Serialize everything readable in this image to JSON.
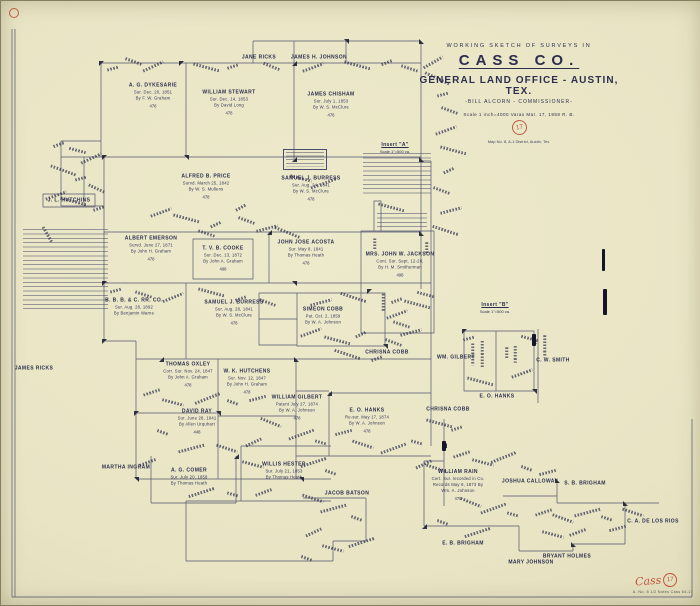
{
  "document": {
    "header": {
      "kicker": "WORKING SKETCH OF SURVEYS IN",
      "county": "CASS CO.",
      "office": "GENERAL LAND OFFICE - AUSTIN, TEX.",
      "commissioner": "-BILL ALCORN - COMMISSIONER-",
      "scale_date": "Scale 1 inch=4000 Varas      Mar. 17, 1958  R. B.",
      "sheet_number": "17",
      "credit": "Map No. 8, A-1 District, Austin, Tex."
    },
    "sheet_stamp": {
      "county_red": "Cass",
      "number": "17",
      "file_note": "A. No. 8  1/2 Notes      Cass 64-17"
    },
    "inserts": [
      {
        "label": "Insert \"A\"",
        "scale": "Scale 1\"=500 va."
      },
      {
        "label": "Insert \"B\"",
        "scale": "Scale 1\"=500 va."
      }
    ],
    "surveys": [
      {
        "n": "Jane Ricks"
      },
      {
        "n": "James H. Johnson"
      },
      {
        "n": "A. G. Dykesarie",
        "d1": "Sur. Dec. 20, 1851",
        "d2": "By F. W. Graham",
        "a": "478"
      },
      {
        "n": "William Stewart",
        "d1": "Sur. Dec. 14, 1853",
        "d2": "By David Long",
        "a": "478"
      },
      {
        "n": "James Chisham",
        "d1": "Sur. July 1, 1853",
        "d2": "By W. S. McClure",
        "a": "478"
      },
      {
        "n": "Alfred B. Price",
        "d1": "Survd. March 25, 1842",
        "d2": "By W. S. Mullens",
        "a": "478"
      },
      {
        "n": "Samuel J. Burress",
        "d1": "Sur. Aug. 24, 1841",
        "d2": "By W. S. McClure",
        "a": "478"
      },
      {
        "n": "Albert Emerson",
        "d1": "Survd. June 27, 1871",
        "d2": "By John H. Graham",
        "a": "478"
      },
      {
        "n": "T. V. B. Cooke",
        "d1": "Sur. Dec. 13, 1872",
        "d2": "By John A. Graham",
        "a": "498"
      },
      {
        "n": "John Jose Acosta",
        "d1": "Sur. May 8, 1841",
        "d2": "By Thomas Heath",
        "a": "478"
      },
      {
        "n": "B. B. B. & C. RR. Co.",
        "d1": "Sur. Aug. 28, 1892",
        "d2": "By Benjamin Warne"
      },
      {
        "n": "Samuel J. Burress",
        "d1": "Sur. Aug. 28, 1841",
        "d2": "By W. S. McClure",
        "a": "478"
      },
      {
        "n": "Simeon Cobb",
        "d1": "Pat. Oct. 2, 1859",
        "d2": "By W. A. Johnson"
      },
      {
        "n": "Thomas Oxley",
        "d1": "Corr. Sur. Nov. 24, 1847",
        "d2": "By John A. Graham",
        "a": "478"
      },
      {
        "n": "W. K. Hutchens",
        "d1": "Sur. Nov. 12, 1847",
        "d2": "By John H. Graham",
        "a": "478"
      },
      {
        "n": "David Ray",
        "d1": "Sur. June 28, 1841",
        "d2": "By Allen Urquhart",
        "a": "448"
      },
      {
        "n": "William Gilbert",
        "d1": "Patent July 27, 1874",
        "d2": "By W. A. Johnson",
        "a": "478"
      },
      {
        "n": "E. O. Hanks",
        "d1": "Re-sur. May 17, 1874",
        "d2": "By W. A. Johnson",
        "a": "478"
      },
      {
        "n": "Willis Hester",
        "d1": "Sur. July 21, 1853",
        "d2": "By Thomas Heath"
      },
      {
        "n": "A. G. Comer",
        "d1": "Sur. July 20, 1858",
        "d2": "By Thomas Heath"
      },
      {
        "n": "Martha Ingram"
      },
      {
        "n": "James Ricks"
      },
      {
        "n": "Jacob Batson"
      },
      {
        "n": "William Rain",
        "d1": "Cert. Sur. recorded in Co.",
        "d2": "Records May 6, 1873 By",
        "d3": "Wm. A. Johnson",
        "a": "478"
      },
      {
        "n": "Joshua Calloway"
      },
      {
        "n": "S. B. Brigham"
      },
      {
        "n": "C. A. de los Rios"
      },
      {
        "n": "E. B. Brigham"
      },
      {
        "n": "Bryant Holmes"
      },
      {
        "n": "Mary Johnson"
      },
      {
        "n": "Wm. Gilbert"
      },
      {
        "n": "C. W. Smith"
      },
      {
        "n": "E. O. Hanks"
      },
      {
        "n": "Chrisna Cobb"
      },
      {
        "n": "Chrisna Cobb"
      },
      {
        "n": "Mrs. John W. Jackson",
        "d1": "Cont. Sur. Sept. 12-28,",
        "d2": "By H. M. Smitherman",
        "a": "498"
      },
      {
        "n": "J. L. Hutchins"
      }
    ]
  }
}
